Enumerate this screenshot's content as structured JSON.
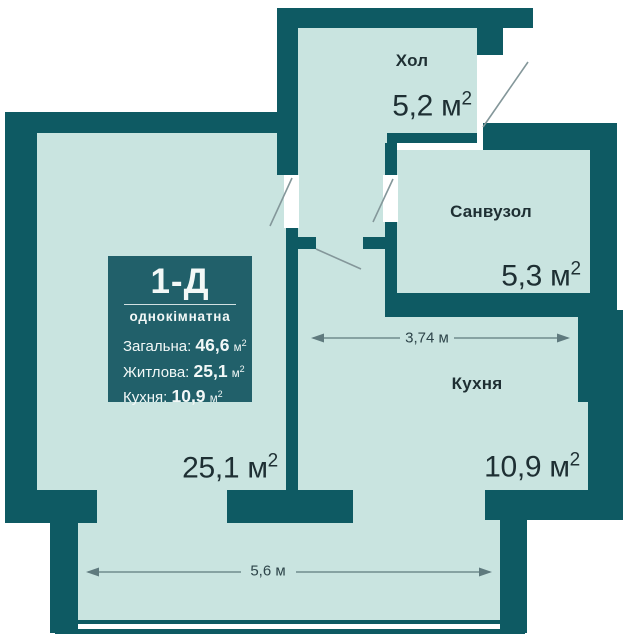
{
  "colors": {
    "wall": "#0e5a63",
    "room": "#c9e4e0",
    "box": "#21606a",
    "text_dark": "#1e2f33",
    "swing": "#84979a",
    "dim": "#5f7a7e",
    "boxtext": "#f2f8f7"
  },
  "unit": {
    "base": "м",
    "sup": "2"
  },
  "rooms": {
    "hall": {
      "name": "Хол",
      "area": "5,2"
    },
    "bathroom": {
      "name": "Санвузол",
      "area": "5,3"
    },
    "kitchen": {
      "name": "Кухня",
      "area": "10,9"
    },
    "living": {
      "area": "25,1"
    }
  },
  "dimensions": {
    "kitchen_width": "3,74 м",
    "balcony_width": "5,6 м"
  },
  "info_box": {
    "plan_code": "1-Д",
    "plan_type": "однокімнатна",
    "stats": [
      {
        "label": "Загальна:",
        "value": "46,6"
      },
      {
        "label": "Житлова:",
        "value": "25,1"
      },
      {
        "label": "Кухня:",
        "value": "10,9"
      }
    ]
  }
}
